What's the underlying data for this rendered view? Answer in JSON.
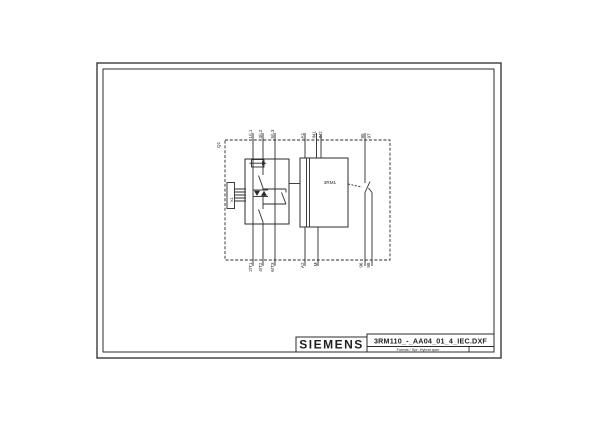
{
  "colors": {
    "background": "#ffffff",
    "line": "#2b2b2b",
    "text": "#1f1f1f"
  },
  "title_block": {
    "brand": "SIEMENS",
    "filename": "3RM110_-_AA04_01_4_IEC.DXF",
    "meta": "Format / Spr: Hybrid quer"
  },
  "schematic": {
    "device_tag": "Q1",
    "control_block_label": "3RM1",
    "connector_label": "X1",
    "top_terminals": [
      {
        "label": "1/L1"
      },
      {
        "label": "3/L2"
      },
      {
        "label": "5/L3"
      },
      {
        "label": "A1"
      },
      {
        "label": "IN1"
      },
      {
        "label": "IN2"
      },
      {
        "label": "95"
      },
      {
        "label": "97"
      }
    ],
    "bottom_terminals": [
      {
        "label": "2/T1"
      },
      {
        "label": "4/T2"
      },
      {
        "label": "6/T3"
      },
      {
        "label": "A2"
      },
      {
        "label": "M"
      },
      {
        "label": "96"
      },
      {
        "label": "98"
      }
    ]
  }
}
